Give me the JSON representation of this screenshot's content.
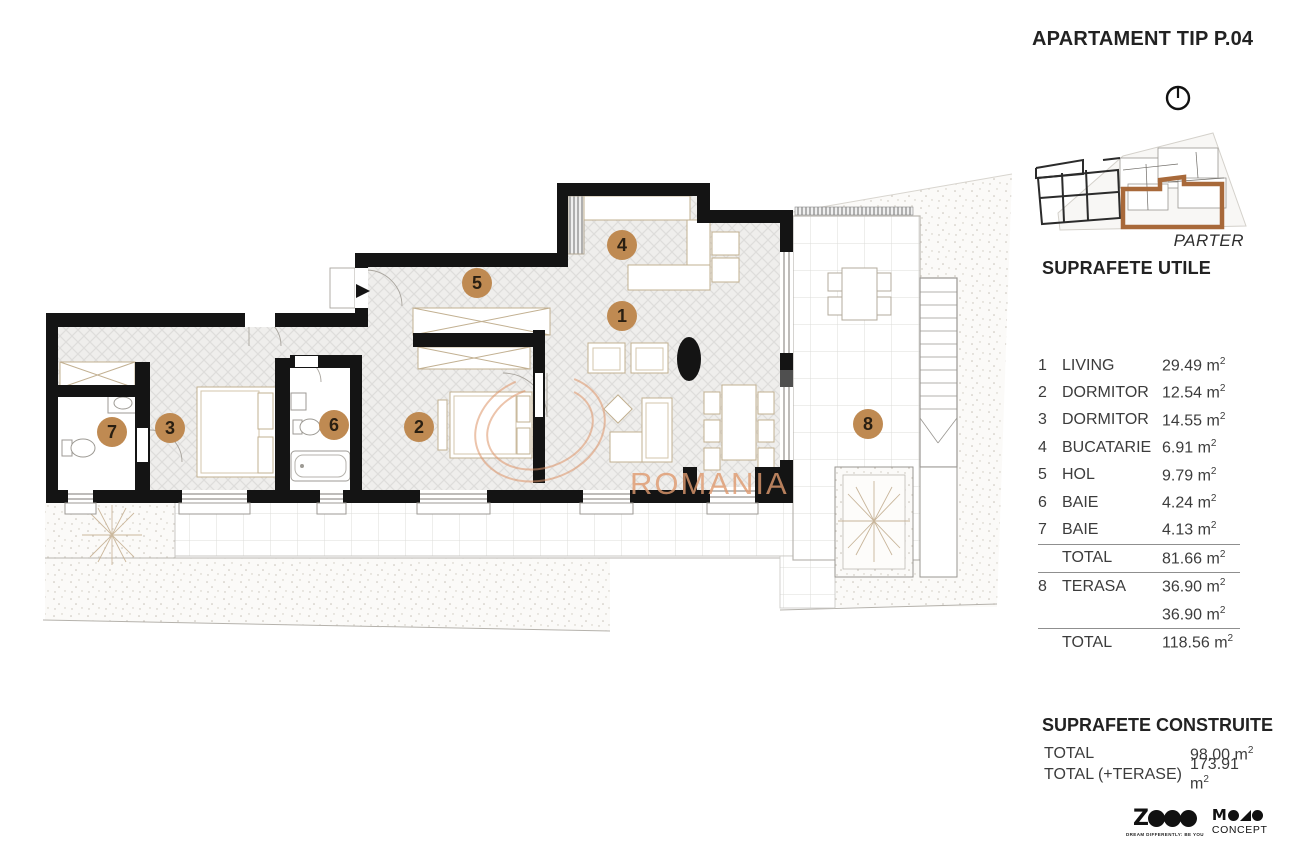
{
  "header": {
    "title": "APARTAMENT TIP P.04"
  },
  "keyplan": {
    "floor_label": "PARTER"
  },
  "sections": {
    "utile": {
      "heading": "SUPRAFETE UTILE",
      "rows": [
        {
          "num": "1",
          "label": "LIVING",
          "value": "29.49 m²"
        },
        {
          "num": "2",
          "label": "DORMITOR",
          "value": "12.54 m²"
        },
        {
          "num": "3",
          "label": "DORMITOR",
          "value": "14.55 m²"
        },
        {
          "num": "4",
          "label": "BUCATARIE",
          "value": "6.91 m²"
        },
        {
          "num": "5",
          "label": "HOL",
          "value": "9.79 m²"
        },
        {
          "num": "6",
          "label": "BAIE",
          "value": "4.24 m²"
        },
        {
          "num": "7",
          "label": "BAIE",
          "value": "4.13 m²"
        }
      ],
      "total_utile": {
        "label": "TOTAL",
        "value": "81.66 m²"
      },
      "terasa_row": {
        "num": "8",
        "label": "TERASA",
        "value": "36.90 m²"
      },
      "terasa_row2": {
        "num": "",
        "label": "",
        "value": "36.90 m²"
      },
      "total_general": {
        "label": "TOTAL",
        "value": "118.56 m²"
      }
    },
    "construite": {
      "heading": "SUPRAFETE CONSTRUITE",
      "rows": [
        {
          "label": "TOTAL",
          "value": "98.00 m²"
        },
        {
          "label": "TOTAL (+TERASE)",
          "value": "173.91 m²"
        }
      ]
    }
  },
  "plan": {
    "markers": [
      "1",
      "2",
      "3",
      "4",
      "5",
      "6",
      "7",
      "8"
    ],
    "watermark": "ROMANIA"
  },
  "logos": {
    "zece_z": "Z",
    "zece_discs": [
      "E",
      "C",
      "E"
    ],
    "zece_tagline": "DREAM DIFFERENTLY: BE YOU",
    "mono_m": "M",
    "mono_sub": "CONCEPT"
  },
  "colors": {
    "marker_brown": "#bf8a52",
    "wall_black": "#141414",
    "watermark_tan": "#e09a6f",
    "keyplan_highlight": "#a8693a"
  }
}
